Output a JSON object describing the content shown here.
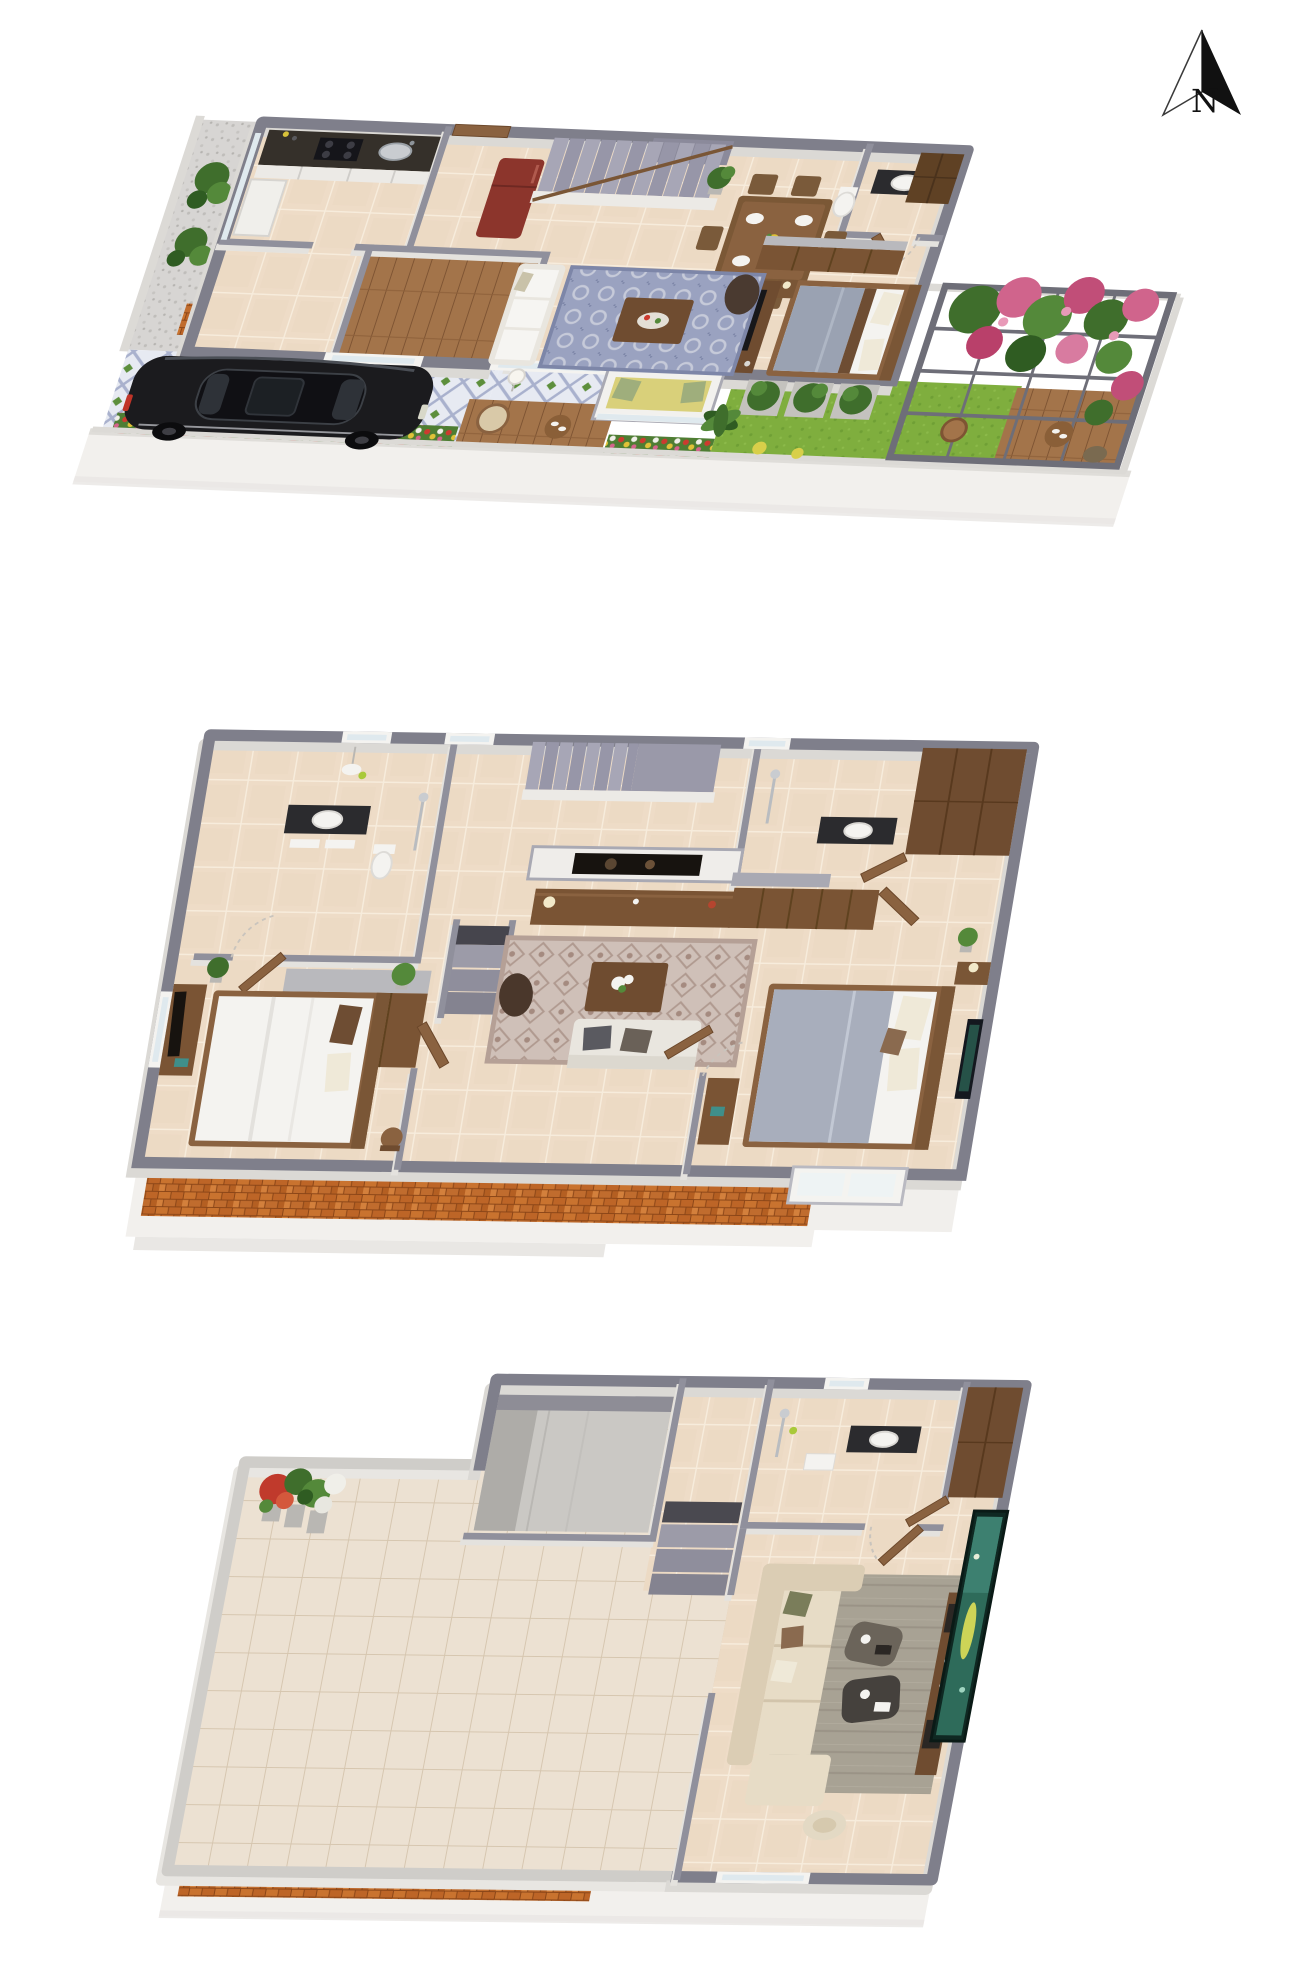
{
  "compass": {
    "label": "N",
    "icon": "north-arrow"
  },
  "scene": {
    "type": "3d-isometric-floor-plan-rendering",
    "floor_count": 3,
    "background": "#ffffff",
    "floors": [
      {
        "id": "ground-floor",
        "position": "top",
        "features": [
          "kitchen-counter-stove-sink",
          "tall-cabinet",
          "refrigerator",
          "rear-door",
          "staircase-up",
          "dining-table-six-chairs",
          "potted-plant",
          "bathroom-vanity-toilet",
          "tall-wardrobe",
          "dresser-unit",
          "double-bed",
          "nightstand-lamp",
          "tv-divider-console",
          "white-sofa",
          "patterned-blue-rug",
          "coffee-table",
          "bean-bag",
          "bay-window-seat",
          "porch-balustrade",
          "utility-wood-deck",
          "side-yard-gravel",
          "shrub-planters",
          "lattice-driveway",
          "black-sedan-car",
          "flower-bed",
          "lawn-garden",
          "palm-plant",
          "wood-deck",
          "pergola-with-pink-bougainvillea",
          "outdoor-round-table",
          "hanging-chair"
        ]
      },
      {
        "id": "first-floor",
        "position": "middle",
        "features": [
          "bathroom-1-vanity-toilet-shower",
          "pendant-lamp",
          "walk-in-wardrobe-block",
          "open-doors",
          "stair-flight-up",
          "stair-well-down",
          "tv-feature-wall",
          "media-console",
          "ornate-rug",
          "coffee-table-flowers",
          "bean-bag",
          "gray-sofa",
          "bathroom-2-vanity-shower",
          "slatted-wardrobe-band",
          "tall-wardrobe",
          "master-bedroom-double-bed",
          "bedside-table-lamp",
          "wall-art",
          "bedroom-2-double-bed",
          "tv-console",
          "house-plants",
          "front-window-bay",
          "brick-clad-front-wall"
        ]
      },
      {
        "id": "second-floor",
        "position": "bottom",
        "features": [
          "open-terrace-tiled",
          "corner-flower-pots",
          "parapet-walls",
          "stair-well-enclosure",
          "arrival-steps",
          "bathroom-3-shower-vanity",
          "wardrobe",
          "wooden-door",
          "home-theater-room",
          "sectional-beige-sofa",
          "two-ottoman-tables",
          "gray-rug",
          "media-console-speakers",
          "large-projection-screen",
          "lounge-pouf",
          "front-window",
          "brick-accent-band"
        ]
      }
    ]
  },
  "palette": {
    "wall_cap": "#7f7f8b",
    "wall_face": "#dbd9d5",
    "parapet": "#cfcdc9",
    "tile_warm": "#eedcc7",
    "tile_cool": "#ece1d2",
    "grout": "#f7ecdc",
    "brick": "#c9732f",
    "brick_mortar": "#8a4517",
    "lawn": "#7fae3e",
    "foliage": "#3f6e2c",
    "flower_pink": "#d0648c",
    "flower_red": "#cc3b2f",
    "flower_yellow": "#e0c238",
    "wood": "#8a6240",
    "wood_dark": "#6f4c30",
    "stair": "#9d9cab",
    "car_body": "#1b1b1e",
    "fridge": "#8c352c",
    "counter": "#35302a",
    "rug_blue": "#9aa2c0",
    "rug_mauve": "#cfc0b8",
    "rug_gray": "#a8a294",
    "sofa_beige": "#dbcdb4",
    "screen_teal": "#2e6b5a",
    "plinth": "#f2f0ed"
  }
}
